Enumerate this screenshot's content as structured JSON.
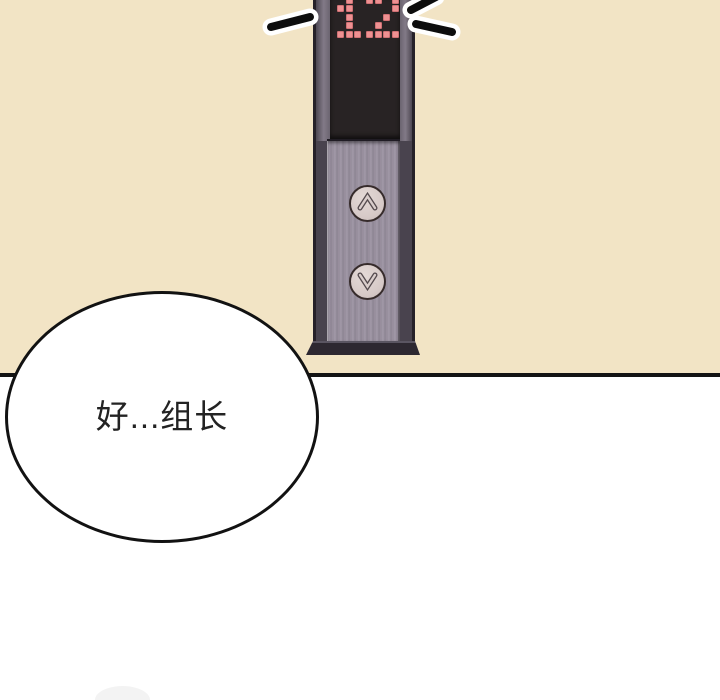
{
  "scene": {
    "type": "webtoon-panel",
    "background_top_color": "#f2e4c5",
    "background_bottom_color": "#ffffff",
    "divider_color": "#141414"
  },
  "elevator_panel": {
    "display": {
      "value": "12",
      "dot_color": "#ee9192",
      "screen_color": "#282324",
      "dot_patterns": {
        "1": [
          ".#.",
          "##.",
          ".#.",
          ".#.",
          "###"
        ],
        "2": [
          "##.#",
          "...#",
          "..#.",
          ".#..",
          "####"
        ]
      }
    },
    "frame_color": "#49434e",
    "plate_color": "#9a91a0",
    "button_face_color": "#dacecc",
    "buttons": {
      "up": {
        "name": "call-up",
        "glyph": "chevron-up"
      },
      "down": {
        "name": "call-down",
        "glyph": "chevron-down"
      }
    },
    "motion_lines": {
      "count": 3,
      "stroke_color": "#0d0d0d",
      "glow_color": "#ffffff"
    }
  },
  "speech_bubble": {
    "text": "好...组长",
    "fill_color": "#ffffff",
    "outline_color": "#121212",
    "text_color": "#232323"
  }
}
